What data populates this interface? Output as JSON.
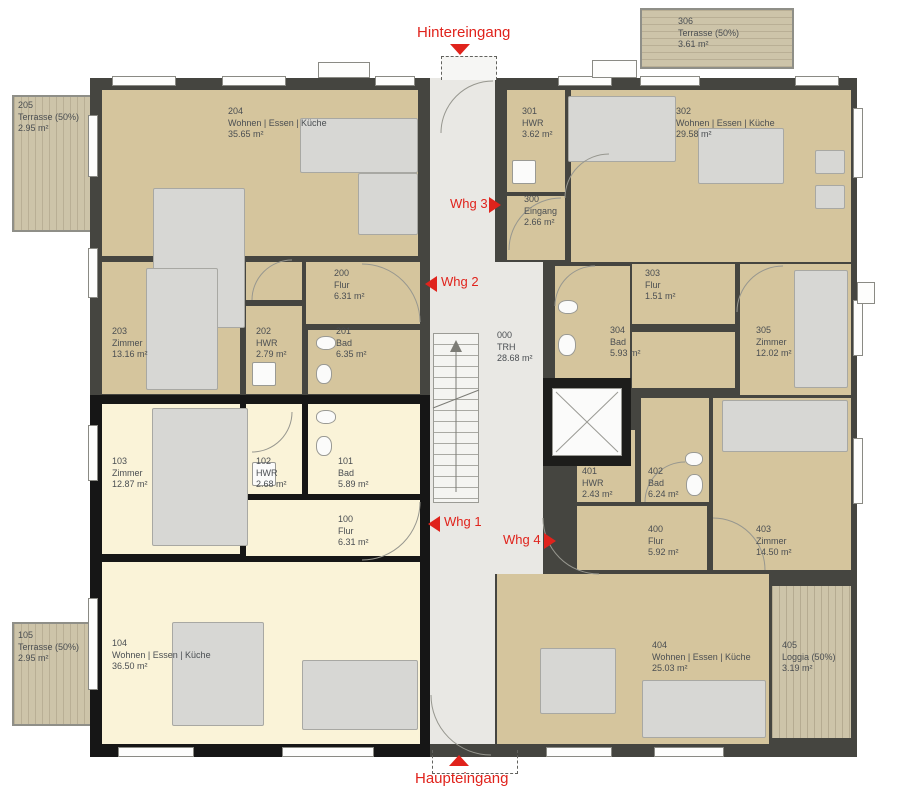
{
  "entrances": {
    "rear": "Hintereingang",
    "main": "Haupteingang"
  },
  "apartments": [
    {
      "label": "Whg 1"
    },
    {
      "label": "Whg 2"
    },
    {
      "label": "Whg 3"
    },
    {
      "label": "Whg 4"
    }
  ],
  "rooms": [
    {
      "number": "205",
      "name": "Terrasse (50%)",
      "area": "2.95 m²"
    },
    {
      "number": "204",
      "name": "Wohnen | Essen | Küche",
      "area": "35.65 m²"
    },
    {
      "number": "203",
      "name": "Zimmer",
      "area": "13.16 m²"
    },
    {
      "number": "202",
      "name": "HWR",
      "area": "2.79 m²"
    },
    {
      "number": "201",
      "name": "Bad",
      "area": "6.35 m²"
    },
    {
      "number": "200",
      "name": "Flur",
      "area": "6.31 m²"
    },
    {
      "number": "105",
      "name": "Terrasse (50%)",
      "area": "2.95 m²"
    },
    {
      "number": "104",
      "name": "Wohnen | Essen | Küche",
      "area": "36.50 m²"
    },
    {
      "number": "103",
      "name": "Zimmer",
      "area": "12.87 m²"
    },
    {
      "number": "102",
      "name": "HWR",
      "area": "2.68 m²"
    },
    {
      "number": "101",
      "name": "Bad",
      "area": "5.89 m²"
    },
    {
      "number": "100",
      "name": "Flur",
      "area": "6.31 m²"
    },
    {
      "number": "000",
      "name": "TRH",
      "area": "28.68 m²"
    },
    {
      "number": "306",
      "name": "Terrasse (50%)",
      "area": "3.61 m²"
    },
    {
      "number": "302",
      "name": "Wohnen | Essen | Küche",
      "area": "29.58 m²"
    },
    {
      "number": "301",
      "name": "HWR",
      "area": "3.62 m²"
    },
    {
      "number": "300",
      "name": "Eingang",
      "area": "2.66 m²"
    },
    {
      "number": "303",
      "name": "Flur",
      "area": "1.51 m²"
    },
    {
      "number": "304",
      "name": "Bad",
      "area": "5.93 m²"
    },
    {
      "number": "305",
      "name": "Zimmer",
      "area": "12.02 m²"
    },
    {
      "number": "401",
      "name": "HWR",
      "area": "2.43 m²"
    },
    {
      "number": "402",
      "name": "Bad",
      "area": "6.24 m²"
    },
    {
      "number": "400",
      "name": "Flur",
      "area": "5.92 m²"
    },
    {
      "number": "403",
      "name": "Zimmer",
      "area": "14.50 m²"
    },
    {
      "number": "404",
      "name": "Wohnen | Essen | Küche",
      "area": "25.03 m²"
    },
    {
      "number": "405",
      "name": "Loggia (50%)",
      "area": "3.19 m²"
    }
  ],
  "colors": {
    "accent_red": "#e0231c",
    "apartment_tan": "#d5c59d",
    "apartment_cream": "#faf3d8",
    "corridor": "#e9e8e4",
    "wall_dark": "#454540",
    "wall_black": "#161616",
    "terrace": "#cdc4a9",
    "label_text": "#4a4e52"
  }
}
